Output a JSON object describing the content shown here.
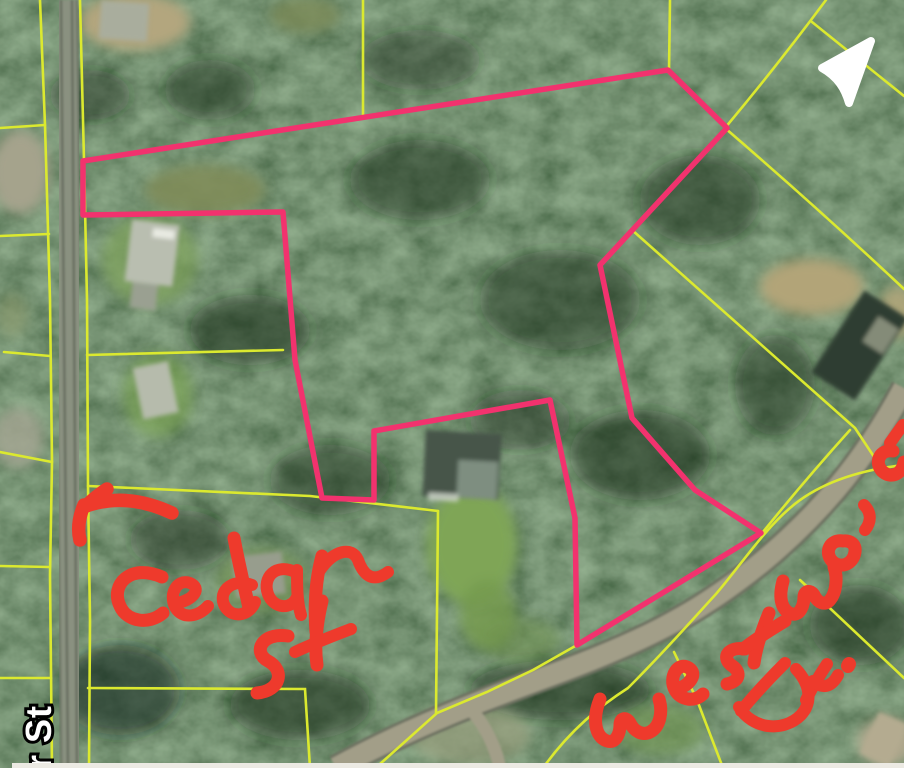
{
  "map": {
    "street_label": {
      "text": "ar St"
    },
    "handwritten_annotations": {
      "cedar_st": {
        "text": "Cedar St",
        "color": "#ee3a2c"
      },
      "westwood_dr": {
        "text": "Westwood Dr.",
        "color": "#ee3a2c"
      }
    },
    "overlay": {
      "highlight_boundary_color": "#f2326e",
      "parcel_line_color": "#dbe92f",
      "street_label_fill": "#ffffff",
      "street_label_outline": "#000000"
    },
    "icons": {
      "navigation_arrow": "navigation-arrow-icon"
    },
    "imagery": {
      "description": "satellite forest with parcels, houses, Cedar St and Westwood Dr roads"
    }
  }
}
